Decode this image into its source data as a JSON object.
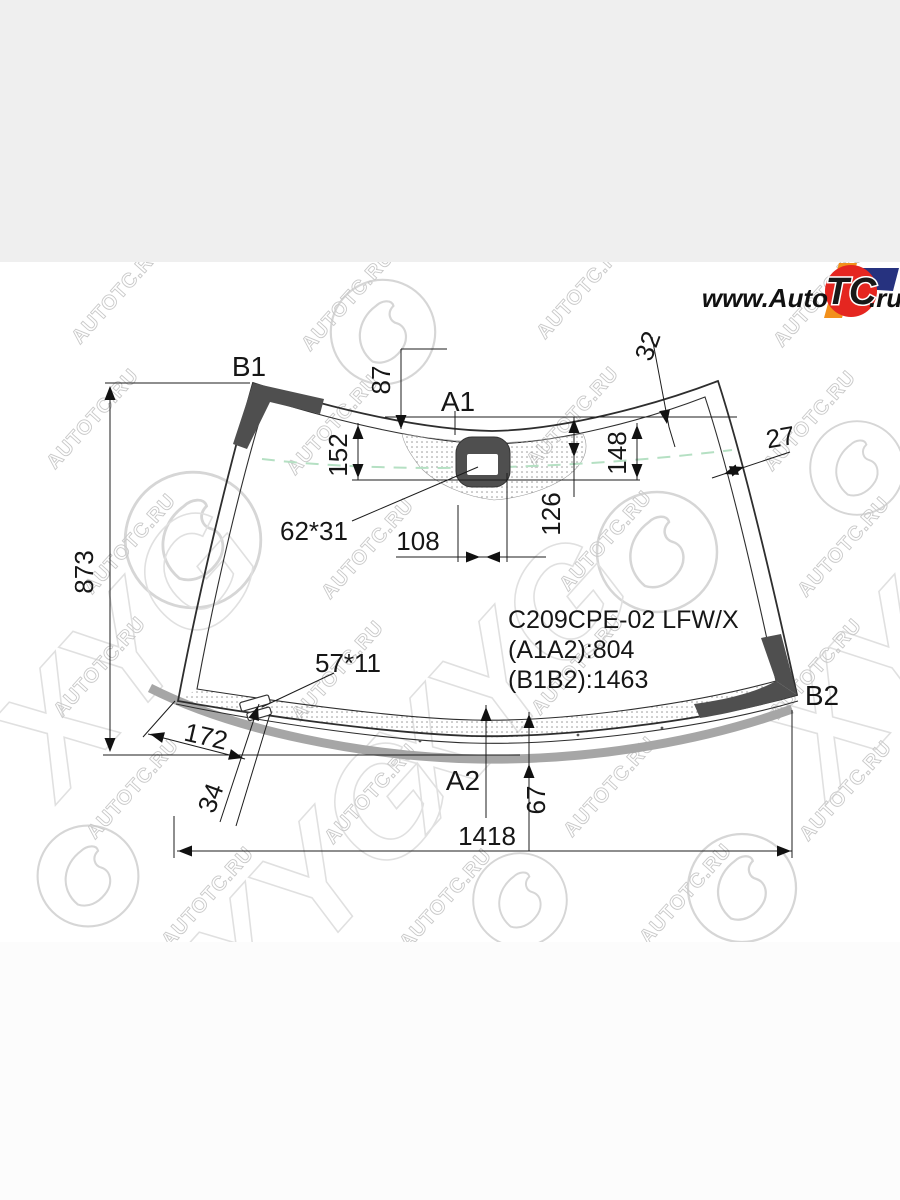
{
  "page": {
    "top_band_color": "#efefef",
    "content_bg": "#ffffff",
    "accent_dark": "#4f4f4f",
    "frit_gray": "#a6a6a6",
    "dash_green": "#b5e0c3"
  },
  "logo": {
    "www_auto": "www.Auto",
    "tc": "TC",
    "ru": ".ru",
    "red": "#e52620",
    "blue": "#26327f",
    "orange": "#f2901c"
  },
  "watermark": {
    "url_text": "AUTOTC.RU",
    "brand": "XYG"
  },
  "drawing": {
    "part_code": "C209CPE-02 LFW/X",
    "spec_a": "(A1A2):804",
    "spec_b": "(B1B2):1463",
    "points": {
      "b1": "B1",
      "a1": "A1",
      "b2": "B2",
      "a2": "A2"
    },
    "dims": {
      "glass_height": "873",
      "sensor_top": "87",
      "corner_top_right": "32",
      "sensor_left": "152",
      "sensor_right": "148",
      "sensor_mid": "126",
      "edge_right": "27",
      "window": "62*31",
      "sensor_offset": "108",
      "clip": "57*11",
      "corner_bottom_left": "172",
      "clip_offset": "34",
      "bottom_drop": "67",
      "glass_width": "1418"
    }
  }
}
